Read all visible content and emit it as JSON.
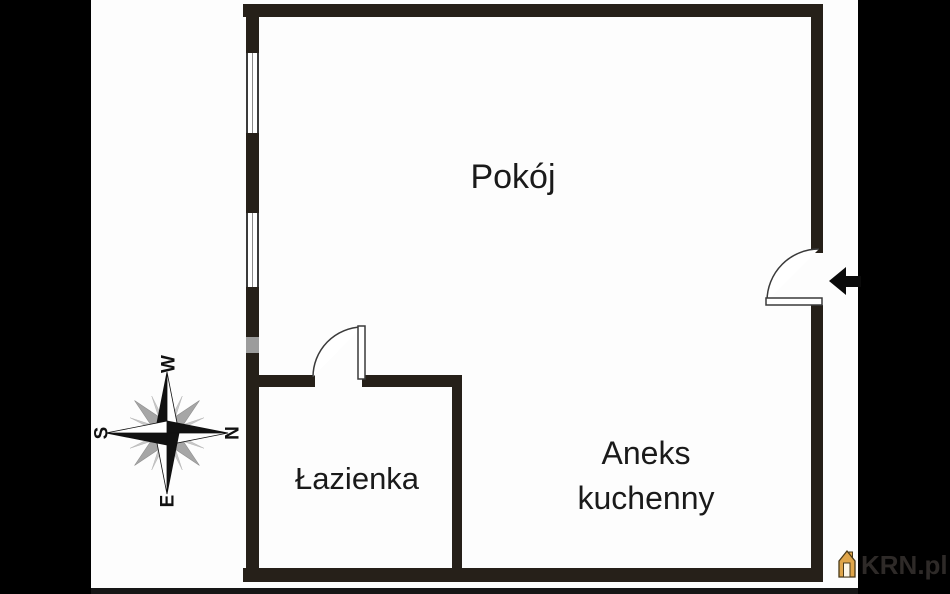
{
  "labels": {
    "room": "Pokój",
    "bathroom": "Łazienka",
    "kitchenette_line1": "Aneks",
    "kitchenette_line2": "kuchenny"
  },
  "compass": {
    "top": "W",
    "right": "N",
    "bottom": "E",
    "left": "S"
  },
  "watermark": {
    "brand": "KRN.pl"
  },
  "colors": {
    "wall": "#262019",
    "side_band": "#000000",
    "background": "#fdfdfd",
    "window_frame": "#3b3b3b",
    "wall_gray_segment": "#9c9c9c",
    "compass_dark": "#111111",
    "compass_gray": "#a6a6a6",
    "compass_light": "#c9c9c9",
    "label_text": "#1a1a1a",
    "watermark_text": "#2e2a28",
    "logo_orange": "#dfa54a"
  }
}
